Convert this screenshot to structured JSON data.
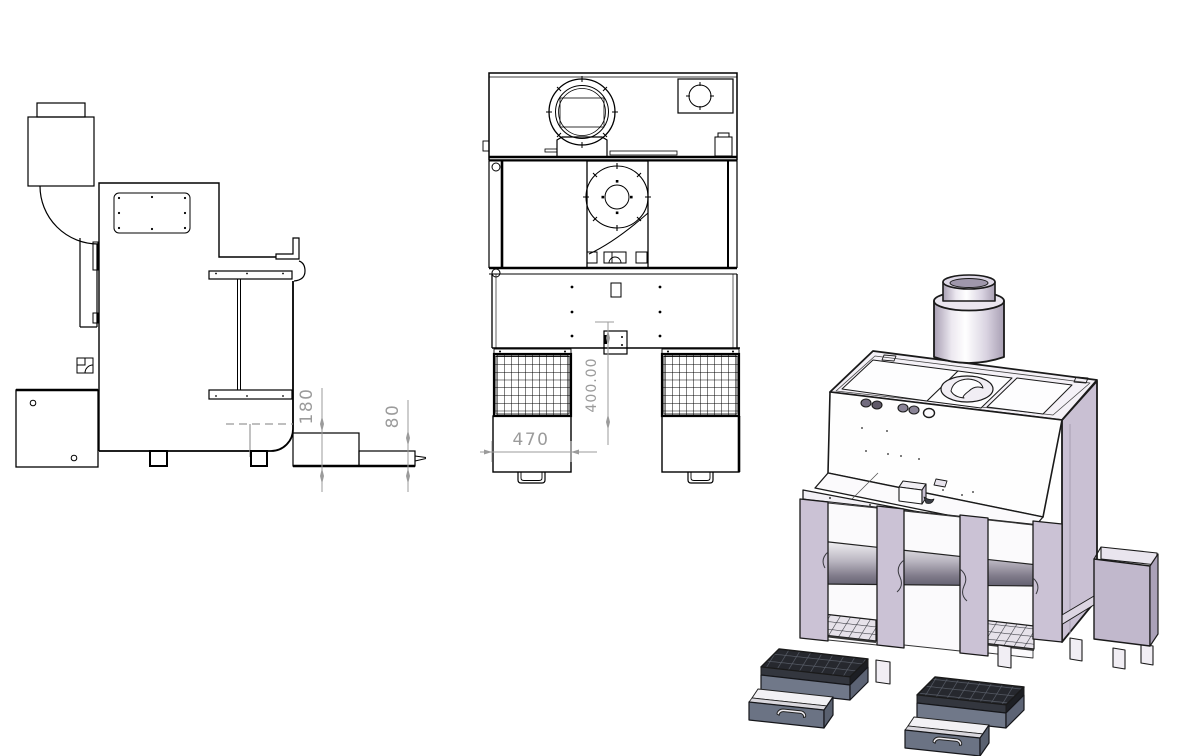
{
  "drawing": {
    "dimensions": {
      "side_step_height": "180",
      "side_outlet_height": "80",
      "front_opening_height": "400.00",
      "front_drawer_width": "470"
    },
    "colors": {
      "line": "#000000",
      "dimension_gray": "#9b9b9b",
      "hidden_line_gray": "#999999",
      "body_lavender": "#cbc2d5",
      "face_white": "#ffffff",
      "top_face": "#f4f1f7",
      "drawer_slate": "#707889",
      "grate_dark": "#26282e",
      "roller_gray": "#8f8a98",
      "hopper_lavender": "#c1b8cc"
    }
  }
}
